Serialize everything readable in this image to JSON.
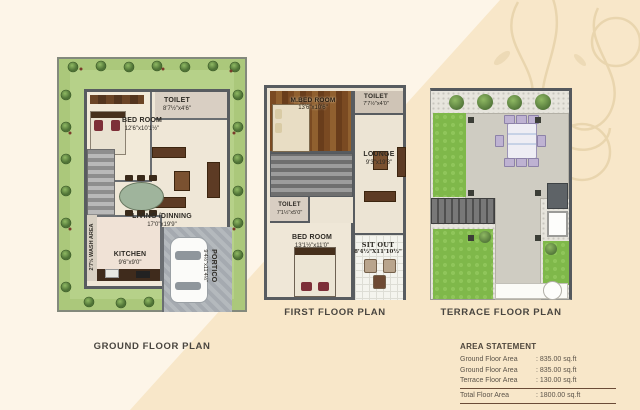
{
  "palette": {
    "background_light": "#fdf5e8",
    "background_dark": "#f8e7c9",
    "lawn_green": "#abc87b",
    "wall_gray": "#585c60",
    "ornament_tan": "#e8d4ac"
  },
  "plans": {
    "ground": {
      "title": "GROUND FLOOR PLAN",
      "bedroom": {
        "name": "BED ROOM",
        "dim": "12'6\"x10'1½\""
      },
      "toilet": {
        "name": "TOILET",
        "dim": "8'7½\"x4'6\""
      },
      "living": {
        "name": "LIVING /DINNING",
        "dim": "17'0\"x19'9\""
      },
      "kitchen": {
        "name": "KITCHEN",
        "dim": "9'6\"x9'0\""
      },
      "wash": {
        "name": "2'7½ WASH AREA"
      },
      "portico": {
        "name": "PORTICO",
        "dim": "9'4½\"x11'4½\""
      }
    },
    "first": {
      "title": "FIRST FLOOR PLAN",
      "mbedroom": {
        "name": "M.BED ROOM",
        "dim": "13'6\"x10'6\""
      },
      "toilet_top": {
        "name": "TOILET",
        "dim": "7'7½\"x4'0\""
      },
      "lounge": {
        "name": "LOUNGE",
        "dim": "9'3\"x19'3\""
      },
      "toilet_small": {
        "name": "TOILET",
        "dim": "7'1½\"x5'0\""
      },
      "bedroom": {
        "name": "BED ROOM",
        "dim": "13'1½\"x11'0\""
      },
      "sitout": {
        "name": "SIT OUT",
        "dim": "8'4½\"X11'10½\""
      }
    },
    "terrace": {
      "title": "TERRACE FLOOR PLAN"
    }
  },
  "area_statement": {
    "title": "AREA STATEMENT",
    "rows": [
      {
        "label": "Ground Floor Area",
        "value": ": 835.00 sq.ft"
      },
      {
        "label": "Ground Floor Area",
        "value": ": 835.00 sq.ft"
      },
      {
        "label": "Terrace Floor Area",
        "value": ": 130.00 sq.ft"
      }
    ],
    "total": {
      "label": "Total Floor Area",
      "value": ": 1800.00 sq.ft"
    }
  }
}
